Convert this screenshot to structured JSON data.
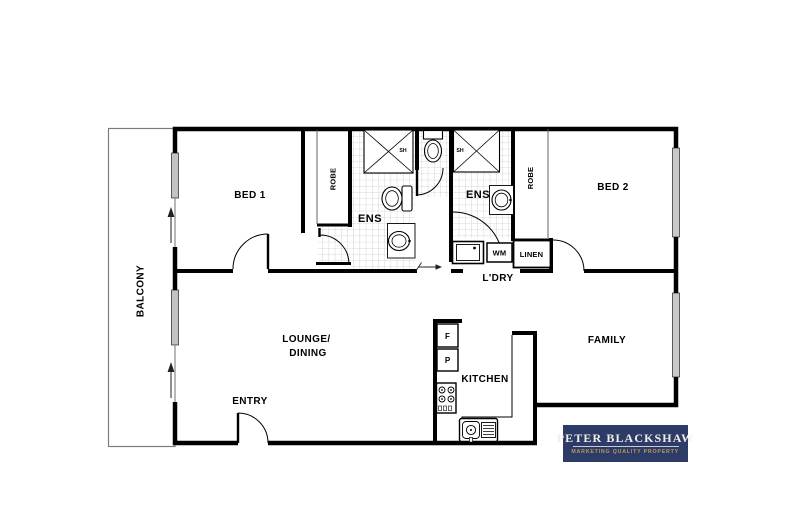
{
  "rooms": {
    "balcony": "BALCONY",
    "bed1": "BED 1",
    "bed2": "BED 2",
    "robe1": "ROBE",
    "robe2": "ROBE",
    "ens1": "ENS",
    "ens2": "ENS",
    "shower1": "SH",
    "shower2": "SH",
    "lounge_line1": "LOUNGE/",
    "lounge_line2": "DINING",
    "entry": "ENTRY",
    "kitchen": "KITCHEN",
    "family": "FAMILY",
    "laundry": "L'DRY",
    "linen": "LINEN"
  },
  "appliances": {
    "washing_machine": "WM",
    "fridge": "F",
    "pantry": "P"
  },
  "logo": {
    "name": "PETER BLACKSHAW",
    "tagline": "MARKETING QUALITY PROPERTY",
    "background": "#2d3c66",
    "name_color": "#f1efe8",
    "tagline_color": "#b59a5f"
  },
  "colors": {
    "wall": "#000000",
    "window_glass": "#c8c8c8",
    "tile_grid": "#cbcbcb",
    "paper": "#ffffff"
  }
}
